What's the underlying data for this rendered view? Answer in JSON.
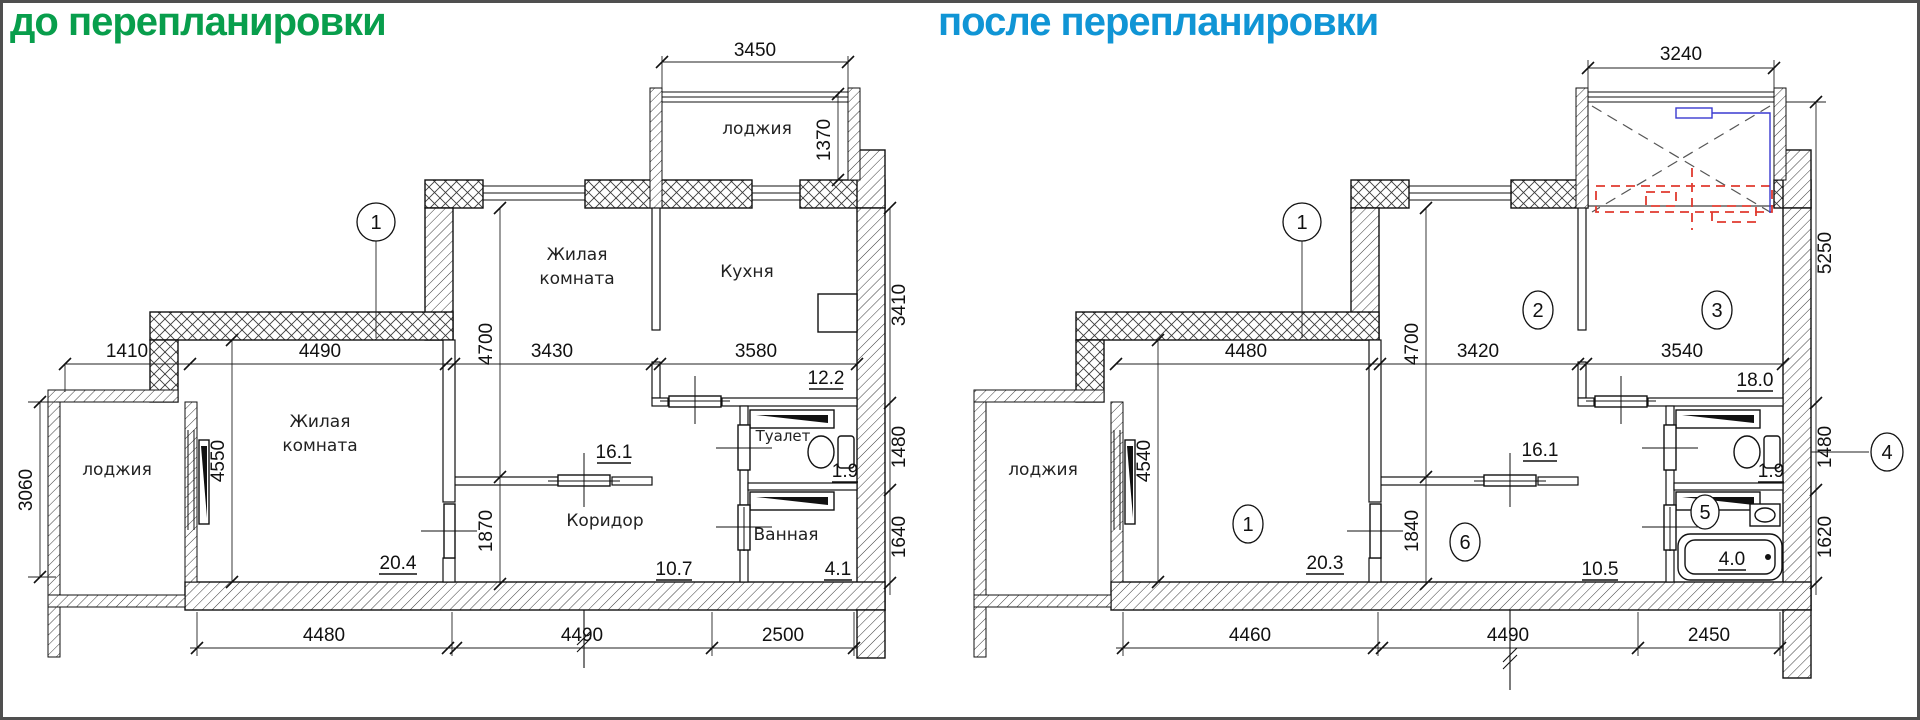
{
  "titles": {
    "before": "до перепланировки",
    "after": "после перепланировки"
  },
  "colors": {
    "title_before": "#089e4c",
    "title_after": "#1095d5",
    "mark_red": "#e03a2f",
    "mark_blue": "#3a3ad0"
  },
  "before": {
    "axis_label": "1",
    "rooms": {
      "top_loggia": "лоджия",
      "left_loggia": "лоджия",
      "living_top_1": "Жилая",
      "living_top_2": "комната",
      "kitchen": "Кухня",
      "living_main_1": "Жилая",
      "living_main_2": "комната",
      "corridor": "Коридор",
      "toilet": "Туалет",
      "bath": "Ванная"
    },
    "areas": {
      "living_top": "16.1",
      "kitchen": "12.2",
      "living_main": "20.4",
      "corridor": "10.7",
      "toilet": "1.9",
      "bath": "4.1"
    },
    "dims": {
      "loggia_top_w": "3450",
      "loggia_top_h": "1370",
      "offset_left": "1410",
      "living_w_top": "4490",
      "room_h": "4700",
      "room_w": "3430",
      "kitchen_w": "3580",
      "kitchen_h": "3410",
      "toilet_h": "1480",
      "bath_h": "1640",
      "loggia_left_h": "3060",
      "living_h": "4550",
      "corridor_h": "1870",
      "bottom_living": "4480",
      "bottom_corridor": "4490",
      "bottom_bath": "2500"
    }
  },
  "after": {
    "axis_label": "1",
    "room_numbers": {
      "living": "1",
      "room2": "2",
      "room3": "3",
      "toilet": "4",
      "bath": "5",
      "corridor": "6"
    },
    "rooms": {
      "left_loggia": "лоджия"
    },
    "areas": {
      "room2": "16.1",
      "room3": "18.0",
      "living": "20.3",
      "corridor": "10.5",
      "toilet": "1.9",
      "bath": "4.0"
    },
    "dims": {
      "loggia_top_w": "3240",
      "right_upper": "5250",
      "living_w_top": "4480",
      "room_h": "4700",
      "room_w": "3420",
      "room3_w": "3540",
      "toilet_h": "1480",
      "bath_h": "1620",
      "living_h": "4540",
      "corridor_h": "1840",
      "bottom_living": "4460",
      "bottom_corridor": "4490",
      "bottom_bath": "2450"
    }
  }
}
